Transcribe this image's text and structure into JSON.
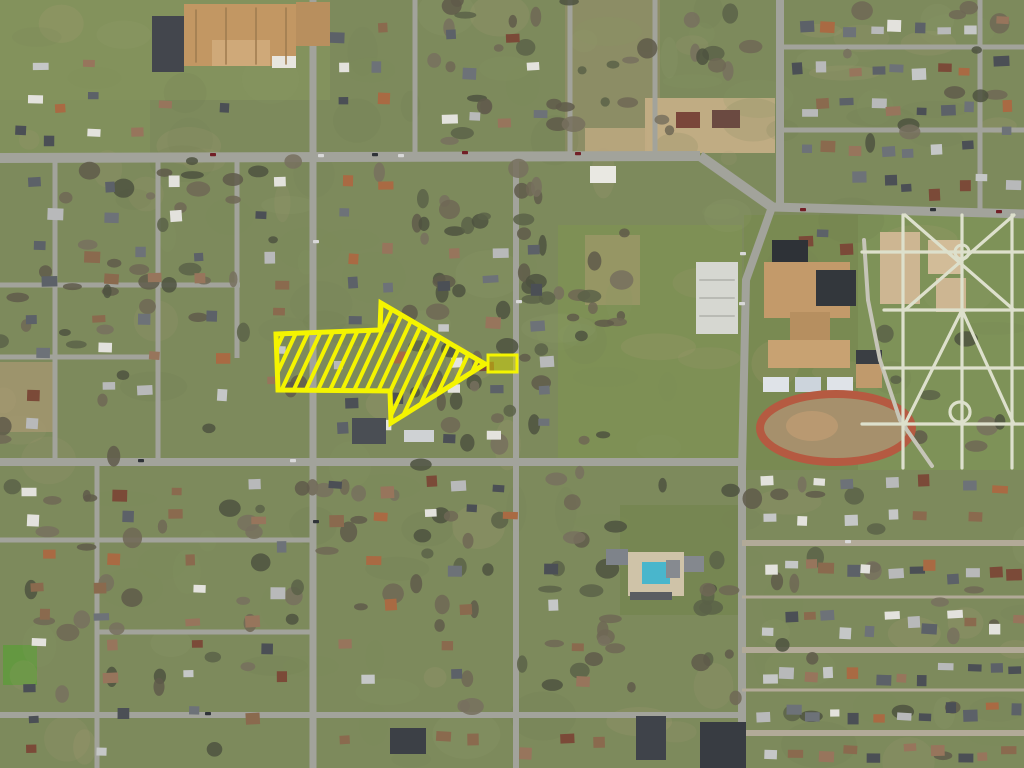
{
  "map": {
    "description": "aerial-photo-residential-neighborhood",
    "palette": {
      "base": "#7d8a5c",
      "noise": [
        "#8a9a63",
        "#6f7f4e",
        "#a89a76",
        "#b3a47e",
        "#7f9055",
        "#96a26d",
        "#74825a"
      ],
      "trees": [
        "#5f5b4a",
        "#6e6755",
        "#4e5240",
        "#77705e",
        "#5a6148"
      ],
      "roofs": [
        "#5c6168",
        "#8a6a4e",
        "#c5c7c7",
        "#a96a43",
        "#e3e2dd",
        "#4b4f55",
        "#97755c",
        "#b8b9ba",
        "#7b4a38",
        "#6d7278"
      ],
      "road": "#a2a39b",
      "vehicles": [
        "#2f3338",
        "#d8d8d8",
        "#721f26",
        "#3b4a66"
      ]
    },
    "patches": [
      {
        "x": 0,
        "y": 0,
        "w": 330,
        "h": 100,
        "c": "#87975e",
        "o": 0.6,
        "name": "lawn"
      },
      {
        "x": 0,
        "y": 0,
        "w": 150,
        "h": 158,
        "c": "#83935c",
        "o": 0.7,
        "name": "lawn"
      },
      {
        "x": 565,
        "y": 0,
        "w": 95,
        "h": 155,
        "c": "#a09070",
        "o": 0.45,
        "name": "dirt-field"
      },
      {
        "x": 645,
        "y": 98,
        "w": 130,
        "h": 55,
        "c": "#c4ae85",
        "o": 0.95,
        "name": "commercial-lot"
      },
      {
        "x": 585,
        "y": 128,
        "w": 62,
        "h": 28,
        "c": "#c0ab82",
        "o": 0.8,
        "name": "dirt-lot"
      },
      {
        "x": 558,
        "y": 225,
        "w": 184,
        "h": 237,
        "c": "#7e9055",
        "o": 1,
        "name": "open-field"
      },
      {
        "x": 744,
        "y": 215,
        "w": 116,
        "h": 255,
        "c": "#798a52",
        "o": 1,
        "name": "school-grounds"
      },
      {
        "x": 858,
        "y": 215,
        "w": 166,
        "h": 255,
        "c": "#7e9258",
        "o": 1,
        "name": "park"
      },
      {
        "x": 0,
        "y": 362,
        "w": 55,
        "h": 70,
        "c": "#ab9973",
        "o": 0.7,
        "name": "dirt-yard"
      },
      {
        "x": 585,
        "y": 235,
        "w": 55,
        "h": 70,
        "c": "#ad9b74",
        "o": 0.5,
        "name": "dirt-yard"
      },
      {
        "x": 3,
        "y": 645,
        "w": 34,
        "h": 40,
        "c": "#5f9a3c",
        "o": 0.85,
        "name": "bright-lawn"
      },
      {
        "x": 620,
        "y": 505,
        "w": 120,
        "h": 110,
        "c": "#74854e",
        "o": 0.7,
        "name": "lawn"
      }
    ],
    "roads": [
      {
        "pts": "0,158 700,156",
        "w": 10,
        "name": "main-road-west"
      },
      {
        "pts": "700,156 772,207",
        "w": 10,
        "name": "main-road-curve"
      },
      {
        "pts": "772,207 1024,214",
        "w": 9,
        "name": "main-road-east"
      },
      {
        "pts": "780,0 780,204",
        "w": 8,
        "name": "avenue-north"
      },
      {
        "pts": "772,207 746,280 742,470 742,768",
        "w": 8,
        "name": "avenue-south"
      },
      {
        "pts": "313,0 313,768",
        "w": 7,
        "name": "street-vertical"
      },
      {
        "pts": "415,0 415,158",
        "w": 5,
        "name": "street-vertical"
      },
      {
        "pts": "570,0 570,158",
        "w": 5,
        "name": "street-vertical"
      },
      {
        "pts": "655,0 655,157",
        "w": 5,
        "name": "street-vertical"
      },
      {
        "pts": "516,157 516,768",
        "w": 6,
        "name": "street-vertical"
      },
      {
        "pts": "55,158 55,462",
        "w": 5,
        "name": "street-vertical"
      },
      {
        "pts": "158,158 158,462",
        "w": 5,
        "name": "street-vertical"
      },
      {
        "pts": "237,158 237,358",
        "w": 5,
        "name": "street-vertical"
      },
      {
        "pts": "97,462 97,768",
        "w": 5,
        "name": "street-vertical"
      },
      {
        "pts": "980,0 980,211",
        "w": 5,
        "name": "street-vertical"
      },
      {
        "pts": "0,285 240,285",
        "w": 5,
        "name": "street-horizontal"
      },
      {
        "pts": "0,357 160,357",
        "w": 5,
        "name": "street-horizontal"
      },
      {
        "pts": "0,462 742,462",
        "w": 8,
        "name": "street-horizontal"
      },
      {
        "pts": "0,540 315,540",
        "w": 5,
        "name": "street-horizontal"
      },
      {
        "pts": "97,632 313,632",
        "w": 5,
        "name": "street-horizontal"
      },
      {
        "pts": "0,715 742,715",
        "w": 6,
        "name": "street-horizontal"
      },
      {
        "pts": "780,47 1024,47",
        "w": 5,
        "name": "street-horizontal"
      },
      {
        "pts": "780,130 1024,130",
        "w": 5,
        "name": "street-horizontal"
      },
      {
        "pts": "742,543 1024,543",
        "w": 6,
        "c": "#b2aa98",
        "name": "street-horizontal"
      },
      {
        "pts": "742,597 1024,597",
        "w": 3,
        "c": "#b2aa98",
        "name": "alley"
      },
      {
        "pts": "742,650 1024,650",
        "w": 6,
        "c": "#b2aa98",
        "name": "street-horizontal"
      },
      {
        "pts": "742,690 1024,690",
        "w": 3,
        "c": "#b2aa98",
        "name": "alley"
      },
      {
        "pts": "742,733 1024,733",
        "w": 6,
        "c": "#b2aa98",
        "name": "street-horizontal"
      }
    ],
    "tree_zones": [
      {
        "x": 400,
        "y": 180,
        "w": 140,
        "h": 290,
        "n": 42
      },
      {
        "x": 540,
        "y": 230,
        "w": 85,
        "h": 230,
        "n": 18
      },
      {
        "x": 300,
        "y": 470,
        "w": 440,
        "h": 245,
        "n": 60
      },
      {
        "x": 0,
        "y": 230,
        "w": 300,
        "h": 230,
        "n": 30
      },
      {
        "x": 420,
        "y": 0,
        "w": 235,
        "h": 150,
        "n": 26
      },
      {
        "x": 0,
        "y": 470,
        "w": 300,
        "h": 295,
        "n": 32
      },
      {
        "x": 752,
        "y": 470,
        "w": 270,
        "h": 295,
        "n": 22
      },
      {
        "x": 840,
        "y": 0,
        "w": 184,
        "h": 150,
        "n": 12
      },
      {
        "x": 0,
        "y": 160,
        "w": 560,
        "h": 70,
        "n": 20
      },
      {
        "x": 862,
        "y": 320,
        "w": 160,
        "h": 150,
        "n": 10
      },
      {
        "x": 660,
        "y": 0,
        "w": 110,
        "h": 150,
        "n": 10
      }
    ],
    "house_blocks": [
      {
        "x": 788,
        "y": 8,
        "w": 186,
        "h": 30,
        "n": 8
      },
      {
        "x": 788,
        "y": 56,
        "w": 186,
        "h": 26,
        "n": 8
      },
      {
        "x": 788,
        "y": 90,
        "w": 186,
        "h": 30,
        "n": 8
      },
      {
        "x": 788,
        "y": 136,
        "w": 186,
        "h": 22,
        "n": 7
      },
      {
        "x": 986,
        "y": 8,
        "w": 36,
        "h": 144,
        "n": 4
      },
      {
        "x": 845,
        "y": 162,
        "w": 175,
        "h": 42,
        "n": 7
      },
      {
        "x": 4,
        "y": 52,
        "w": 120,
        "h": 100,
        "n": 6
      },
      {
        "x": 6,
        "y": 95,
        "w": 295,
        "h": 52,
        "n": 5
      },
      {
        "x": 322,
        "y": 12,
        "w": 80,
        "h": 140,
        "n": 6
      },
      {
        "x": 432,
        "y": 16,
        "w": 120,
        "h": 70,
        "n": 4
      },
      {
        "x": 420,
        "y": 95,
        "w": 140,
        "h": 50,
        "n": 4
      },
      {
        "x": 6,
        "y": 168,
        "w": 295,
        "h": 58,
        "n": 8
      },
      {
        "x": 325,
        "y": 163,
        "w": 85,
        "h": 60,
        "n": 3
      },
      {
        "x": 10,
        "y": 232,
        "w": 290,
        "h": 205,
        "n": 26
      },
      {
        "x": 322,
        "y": 232,
        "w": 88,
        "h": 215,
        "n": 12
      },
      {
        "x": 430,
        "y": 232,
        "w": 80,
        "h": 215,
        "n": 12
      },
      {
        "x": 522,
        "y": 232,
        "w": 34,
        "h": 215,
        "n": 6
      },
      {
        "x": 790,
        "y": 220,
        "w": 66,
        "h": 42,
        "n": 3
      },
      {
        "x": 4,
        "y": 470,
        "w": 300,
        "h": 290,
        "n": 34
      },
      {
        "x": 322,
        "y": 468,
        "w": 200,
        "h": 58,
        "n": 10
      },
      {
        "x": 322,
        "y": 548,
        "w": 300,
        "h": 150,
        "n": 12
      },
      {
        "x": 330,
        "y": 722,
        "w": 330,
        "h": 42,
        "n": 8
      },
      {
        "x": 752,
        "y": 468,
        "w": 270,
        "h": 64,
        "n": 13
      },
      {
        "x": 752,
        "y": 550,
        "w": 270,
        "h": 42,
        "n": 13
      },
      {
        "x": 752,
        "y": 602,
        "w": 270,
        "h": 42,
        "n": 13
      },
      {
        "x": 752,
        "y": 656,
        "w": 270,
        "h": 30,
        "n": 12
      },
      {
        "x": 752,
        "y": 694,
        "w": 270,
        "h": 34,
        "n": 12
      },
      {
        "x": 752,
        "y": 738,
        "w": 270,
        "h": 26,
        "n": 10
      }
    ],
    "features": [
      {
        "t": "rect",
        "x": 152,
        "y": 16,
        "w": 32,
        "h": 56,
        "c": "#43464d",
        "name": "parking-lot-dark"
      },
      {
        "t": "rect",
        "x": 184,
        "y": 4,
        "w": 112,
        "h": 62,
        "c": "#c29763",
        "name": "large-building-main"
      },
      {
        "t": "rect",
        "x": 296,
        "y": 2,
        "w": 34,
        "h": 44,
        "c": "#b88f5e",
        "name": "large-building-wing"
      },
      {
        "t": "rect",
        "x": 212,
        "y": 40,
        "w": 58,
        "h": 26,
        "c": "#cfa979",
        "name": "large-building-section"
      },
      {
        "t": "rect",
        "x": 272,
        "y": 56,
        "w": 24,
        "h": 12,
        "c": "#e8e6df",
        "name": "large-building-white-roof"
      },
      {
        "t": "lines",
        "segs": [
          [
            196,
            10,
            196,
            62
          ],
          [
            226,
            8,
            226,
            64
          ],
          [
            256,
            8,
            256,
            64
          ],
          [
            286,
            8,
            286,
            64
          ]
        ],
        "c": "#9d7b4f",
        "w": 1.5,
        "name": "building-roof-ridges"
      },
      {
        "t": "rect",
        "x": 676,
        "y": 112,
        "w": 24,
        "h": 16,
        "c": "#7a463a",
        "name": "store-building"
      },
      {
        "t": "rect",
        "x": 712,
        "y": 110,
        "w": 28,
        "h": 18,
        "c": "#6b4a41",
        "name": "store-building"
      },
      {
        "t": "rect",
        "x": 590,
        "y": 166,
        "w": 26,
        "h": 17,
        "c": "#e9e8e2",
        "name": "white-building"
      },
      {
        "t": "rect",
        "x": 696,
        "y": 262,
        "w": 42,
        "h": 72,
        "c": "#d6d7d1",
        "name": "school-parking"
      },
      {
        "t": "lines",
        "segs": [
          [
            700,
            280,
            734,
            280
          ],
          [
            700,
            298,
            734,
            298
          ],
          [
            700,
            316,
            734,
            316
          ]
        ],
        "c": "#b9bab4",
        "w": 2,
        "name": "parking-row-lines"
      },
      {
        "t": "rect",
        "x": 772,
        "y": 240,
        "w": 36,
        "h": 24,
        "c": "#2e3237",
        "name": "school-roof-dark"
      },
      {
        "t": "rect",
        "x": 764,
        "y": 262,
        "w": 86,
        "h": 56,
        "c": "#c39a6a",
        "name": "school-building"
      },
      {
        "t": "rect",
        "x": 816,
        "y": 270,
        "w": 40,
        "h": 36,
        "c": "#33373c",
        "name": "school-roof-dark"
      },
      {
        "t": "rect",
        "x": 790,
        "y": 312,
        "w": 40,
        "h": 28,
        "c": "#b68f60",
        "name": "school-building"
      },
      {
        "t": "rect",
        "x": 768,
        "y": 340,
        "w": 82,
        "h": 28,
        "c": "#c8a272",
        "name": "school-building"
      },
      {
        "t": "rect",
        "x": 856,
        "y": 350,
        "w": 26,
        "h": 38,
        "c": "#c09a6c",
        "name": "school-annex"
      },
      {
        "t": "rect",
        "x": 856,
        "y": 350,
        "w": 26,
        "h": 14,
        "c": "#3a3e43",
        "name": "school-annex-shadow"
      },
      {
        "t": "rect",
        "x": 763,
        "y": 377,
        "w": 26,
        "h": 15,
        "c": "#dfe3e8",
        "name": "bus-garage"
      },
      {
        "t": "rect",
        "x": 795,
        "y": 377,
        "w": 26,
        "h": 15,
        "c": "#ccd4dc",
        "name": "bus-garage"
      },
      {
        "t": "rect",
        "x": 827,
        "y": 377,
        "w": 26,
        "h": 15,
        "c": "#dfe3e8",
        "name": "bus-garage"
      },
      {
        "t": "ring",
        "cx": 836,
        "cy": 428,
        "rx": 76,
        "ry": 34,
        "fill": "#a6906c",
        "c": "#b55a41",
        "w": 8,
        "name": "running-track"
      },
      {
        "t": "ellipse",
        "cx": 812,
        "cy": 426,
        "rx": 26,
        "ry": 15,
        "c": "#bb9a72",
        "o": 0.9,
        "name": "track-infield-dirt"
      },
      {
        "t": "rect",
        "x": 880,
        "y": 232,
        "w": 40,
        "h": 72,
        "c": "#cdb692",
        "name": "dirt-court"
      },
      {
        "t": "rect",
        "x": 928,
        "y": 240,
        "w": 34,
        "h": 34,
        "c": "#d2bc98",
        "name": "dirt-court"
      },
      {
        "t": "rect",
        "x": 936,
        "y": 278,
        "w": 30,
        "h": 34,
        "c": "#cdb692",
        "name": "dirt-court"
      },
      {
        "t": "lines",
        "segs": [
          [
            864,
            240,
            868,
            300
          ],
          [
            868,
            300,
            880,
            360
          ],
          [
            880,
            360,
            900,
            420
          ],
          [
            900,
            420,
            932,
            466
          ]
        ],
        "c": "#c6c5b8",
        "w": 4,
        "name": "park-road"
      },
      {
        "t": "lines",
        "segs": [
          [
            903,
            215,
            903,
            468
          ],
          [
            962,
            215,
            962,
            468
          ],
          [
            1012,
            215,
            1012,
            468
          ],
          [
            862,
            252,
            1024,
            252
          ],
          [
            884,
            310,
            1024,
            310
          ],
          [
            884,
            368,
            1024,
            368
          ],
          [
            862,
            424,
            1024,
            424
          ],
          [
            905,
            215,
            1014,
            310
          ],
          [
            1014,
            215,
            905,
            310
          ],
          [
            962,
            310,
            1014,
            424
          ],
          [
            962,
            310,
            905,
            424
          ]
        ],
        "c": "#dde0cc",
        "w": 3.2,
        "name": "park-path"
      },
      {
        "t": "circle",
        "cx": 962,
        "cy": 252,
        "r": 7,
        "c": "#dde0cc",
        "w": 3,
        "name": "park-path-node"
      },
      {
        "t": "circle",
        "cx": 960,
        "cy": 412,
        "r": 10,
        "c": "#dde0cc",
        "w": 3.2,
        "name": "park-path-node"
      },
      {
        "t": "rect",
        "x": 628,
        "y": 552,
        "w": 56,
        "h": 44,
        "c": "#cfc3a8",
        "name": "pool-deck"
      },
      {
        "t": "rect",
        "x": 642,
        "y": 562,
        "w": 28,
        "h": 22,
        "c": "#49b6cc",
        "name": "swimming-pool"
      },
      {
        "t": "rect",
        "x": 666,
        "y": 560,
        "w": 14,
        "h": 18,
        "c": "#868a90",
        "name": "pool-building"
      },
      {
        "t": "rect",
        "x": 606,
        "y": 549,
        "w": 22,
        "h": 16,
        "c": "#7e838a",
        "name": "pool-building"
      },
      {
        "t": "rect",
        "x": 684,
        "y": 556,
        "w": 20,
        "h": 16,
        "c": "#84888e",
        "name": "pool-building"
      },
      {
        "t": "rect",
        "x": 630,
        "y": 592,
        "w": 42,
        "h": 8,
        "c": "#5a5d62",
        "name": "pool-parking"
      },
      {
        "t": "rect",
        "x": 700,
        "y": 722,
        "w": 46,
        "h": 46,
        "c": "#383c42",
        "name": "church-building"
      },
      {
        "t": "rect",
        "x": 636,
        "y": 716,
        "w": 30,
        "h": 44,
        "c": "#3f434a",
        "name": "dark-roof-building"
      },
      {
        "t": "rect",
        "x": 390,
        "y": 728,
        "w": 36,
        "h": 26,
        "c": "#3c4046",
        "name": "dark-roof-building"
      },
      {
        "t": "rect",
        "x": 352,
        "y": 418,
        "w": 34,
        "h": 26,
        "c": "#4a4e54",
        "name": "dark-roof-building"
      },
      {
        "t": "rect",
        "x": 404,
        "y": 430,
        "w": 30,
        "h": 12,
        "c": "#cfd2d4",
        "name": "light-roof-building"
      }
    ],
    "vehicles": [
      [
        210,
        153
      ],
      [
        318,
        154
      ],
      [
        372,
        153
      ],
      [
        398,
        154
      ],
      [
        462,
        151
      ],
      [
        575,
        152
      ],
      [
        740,
        252
      ],
      [
        739,
        302
      ],
      [
        800,
        208
      ],
      [
        930,
        208
      ],
      [
        996,
        210
      ],
      [
        138,
        459
      ],
      [
        290,
        459
      ],
      [
        205,
        712
      ],
      [
        845,
        540
      ],
      [
        313,
        240
      ],
      [
        313,
        520
      ],
      [
        516,
        300
      ]
    ]
  },
  "annotation": {
    "color": "#f4f400",
    "outline_width": 5,
    "hatch_spacing": 11,
    "hatch_width": 4,
    "arrow_points": "276,334 380,330 381,303 485,364 391,423 390,391 278,390",
    "parcel": {
      "x": 488,
      "y": 355,
      "w": 29,
      "h": 17,
      "sw": 3,
      "fill": "#d6d800",
      "opacity": 0.5
    }
  }
}
